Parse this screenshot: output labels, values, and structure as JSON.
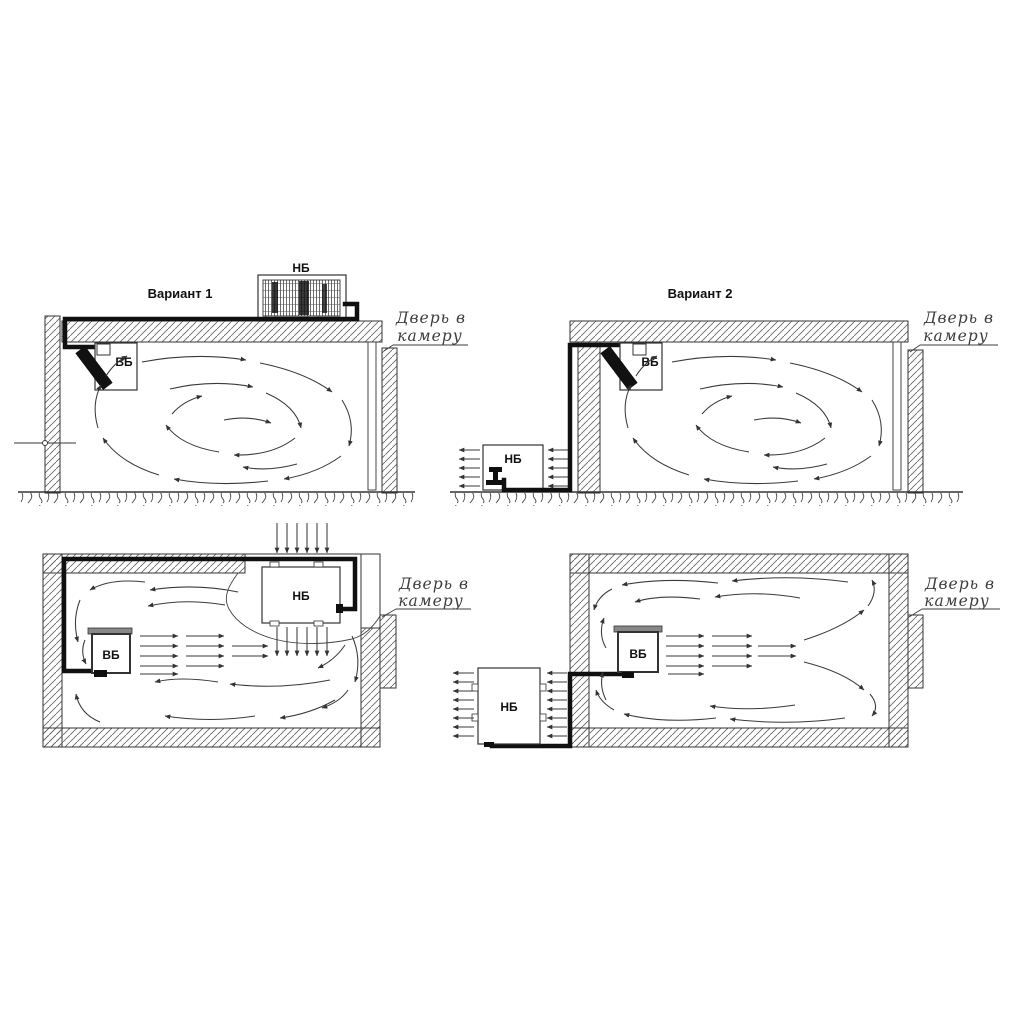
{
  "colors": {
    "background": "#ffffff",
    "line": "#333333",
    "pipe": "#101010",
    "hatch": "#6a6a6a",
    "label_text": "#111111",
    "note_text": "#3d3d3d",
    "unit_fill": "#ffffff",
    "indoor_unit_top_bar": "#888888"
  },
  "variant1": {
    "title": "Вариант 1",
    "side_view": {
      "outdoor_unit_label": "НБ",
      "indoor_unit_label": "ВБ",
      "door_note": {
        "line1": "Дверь в",
        "line2": "камеру"
      }
    },
    "plan_view": {
      "outdoor_unit_label": "НБ",
      "indoor_unit_label": "ВБ",
      "door_note": {
        "line1": "Дверь в",
        "line2": "камеру"
      }
    }
  },
  "variant2": {
    "title": "Вариант 2",
    "side_view": {
      "outdoor_unit_label": "НБ",
      "indoor_unit_label": "ВБ",
      "door_note": {
        "line1": "Дверь в",
        "line2": "камеру"
      }
    },
    "plan_view": {
      "outdoor_unit_label": "НБ",
      "indoor_unit_label": "ВБ",
      "door_note": {
        "line1": "Дверь в",
        "line2": "камеру"
      }
    }
  }
}
